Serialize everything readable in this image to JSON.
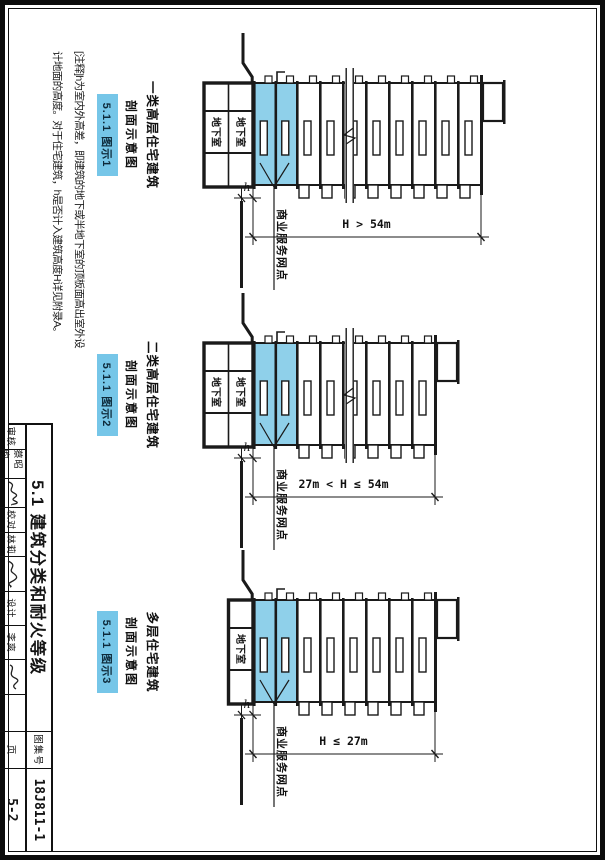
{
  "note": {
    "line1": "[注释]h为室内外高差，即建筑的地下或半地下室的顶板面高出室外设",
    "line2": "计地面的高度。对于住宅建筑，h是否计入建筑高度H详见附录A。"
  },
  "diagrams": [
    {
      "caption_line1": "一类高层住宅建筑",
      "caption_line2": "剖面示意图",
      "badge": "5.1.1 图示1",
      "height_dim_label": "H > 54m",
      "h_dim_label": "h",
      "basement_label": "地下室",
      "commercial_label": "商业服务网点",
      "floors_above_commercial": 8,
      "basement_levels": 2,
      "has_break_line": true
    },
    {
      "caption_line1": "二类高层住宅建筑",
      "caption_line2": "剖面示意图",
      "badge": "5.1.1 图示2",
      "height_dim_label": "27m < H ≤ 54m",
      "h_dim_label": "h",
      "basement_label": "地下室",
      "commercial_label": "商业服务网点",
      "floors_above_commercial": 6,
      "basement_levels": 2,
      "has_break_line": true
    },
    {
      "caption_line1": "多层住宅建筑",
      "caption_line2": "剖面示意图",
      "badge": "5.1.1 图示3",
      "height_dim_label": "H ≤ 27m",
      "h_dim_label": "h",
      "basement_label": "地下室",
      "commercial_label": "商业服务网点",
      "floors_above_commercial": 6,
      "basement_levels": 1,
      "has_break_line": false
    }
  ],
  "titleblock": {
    "title": "5.1 建筑分类和耐火等级",
    "fig_no_label": "图集号",
    "fig_no": "18J811-1",
    "page_label": "页",
    "page_no": "5-2",
    "credits": [
      {
        "role": "审核",
        "name": "蔡昭昀"
      },
      {
        "role": "校对",
        "name": "林莉"
      },
      {
        "role": "设计",
        "name": "李爽"
      }
    ]
  },
  "colors": {
    "highlight_fill": "#8fd0ea",
    "badge_fill": "#76c6e8",
    "line": "#1a1a1a"
  }
}
